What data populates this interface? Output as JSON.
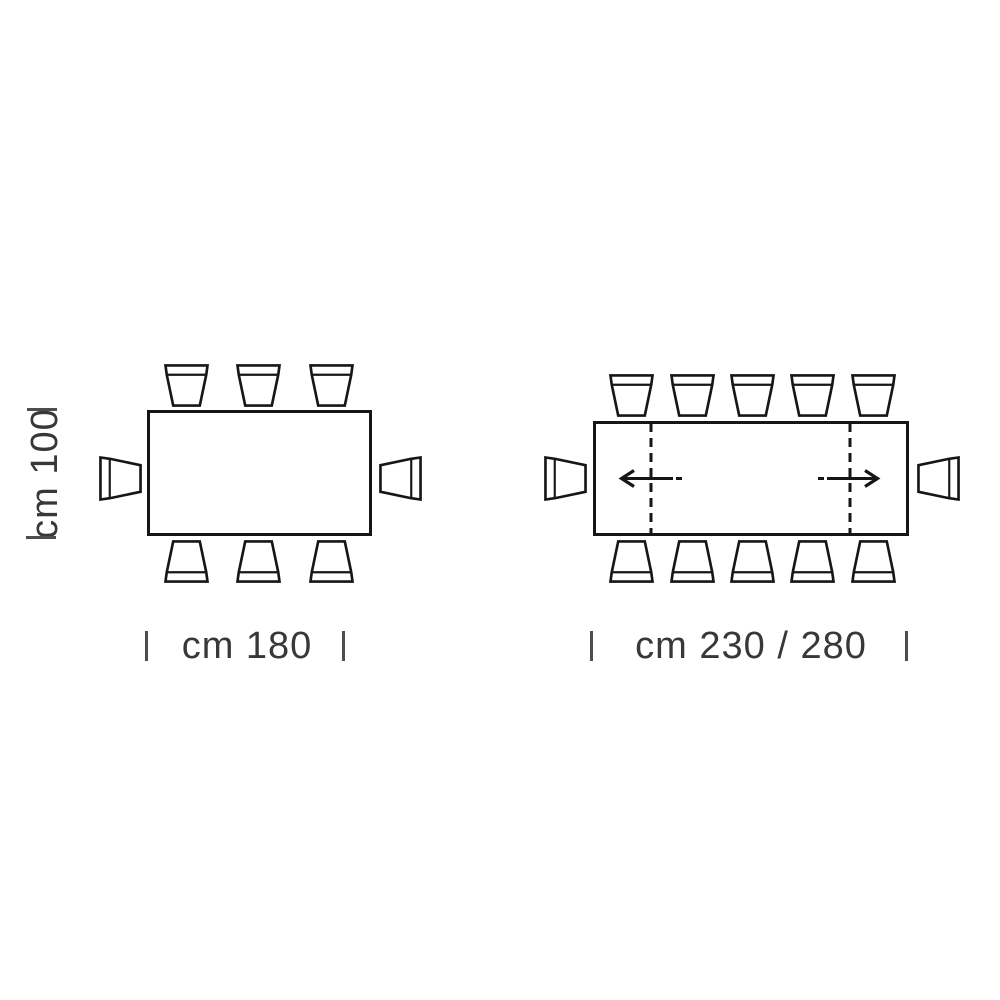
{
  "page": {
    "background": "#ffffff"
  },
  "left_diagram": {
    "type": "fixed-table-plan-view",
    "depth_dimension": "cm 100",
    "width_dimension": "cm 180",
    "chairs": {
      "top": 3,
      "bottom": 3,
      "left_end": 1,
      "right_end": 1,
      "total": 8
    }
  },
  "right_diagram": {
    "type": "extendable-table-plan-view",
    "width_dimension": "cm 230 / 280",
    "extension_leaves": 2,
    "leaf_line_style": "dashed",
    "arrow_directions": [
      "left",
      "right"
    ],
    "chairs": {
      "top": 5,
      "bottom": 5,
      "left_end": 1,
      "right_end": 1,
      "total": 12
    }
  },
  "colors": {
    "line": "#161616",
    "text": "#383838",
    "tick": "#4d4d4d",
    "background": "#ffffff"
  }
}
